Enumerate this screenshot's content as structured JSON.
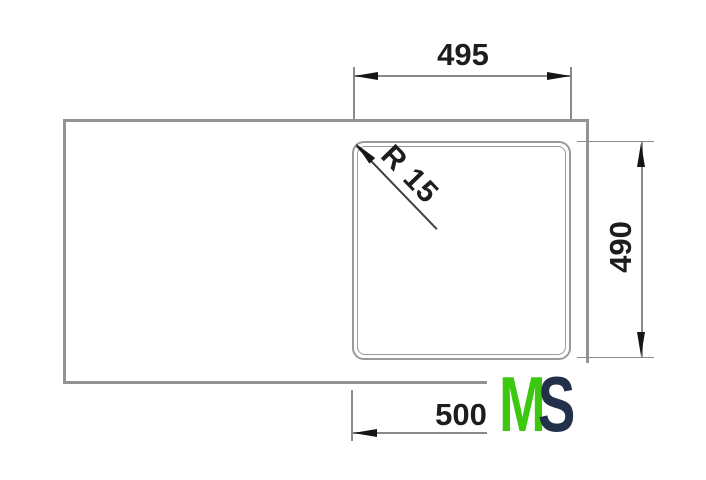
{
  "drawing": {
    "top_dimension_label": "495",
    "right_dimension_label": "490",
    "bottom_dimension_label": "500",
    "radius_label": "R 15"
  },
  "watermark": {
    "letter_m": "M",
    "letter_s": "S",
    "m_color": "#3cc80f",
    "s_color": "#223049"
  },
  "colors": {
    "outline_gray": "#939393",
    "dimension_gray": "#8a8a8a",
    "arrow_black": "#151515",
    "text_dark": "#1d1d1d"
  }
}
